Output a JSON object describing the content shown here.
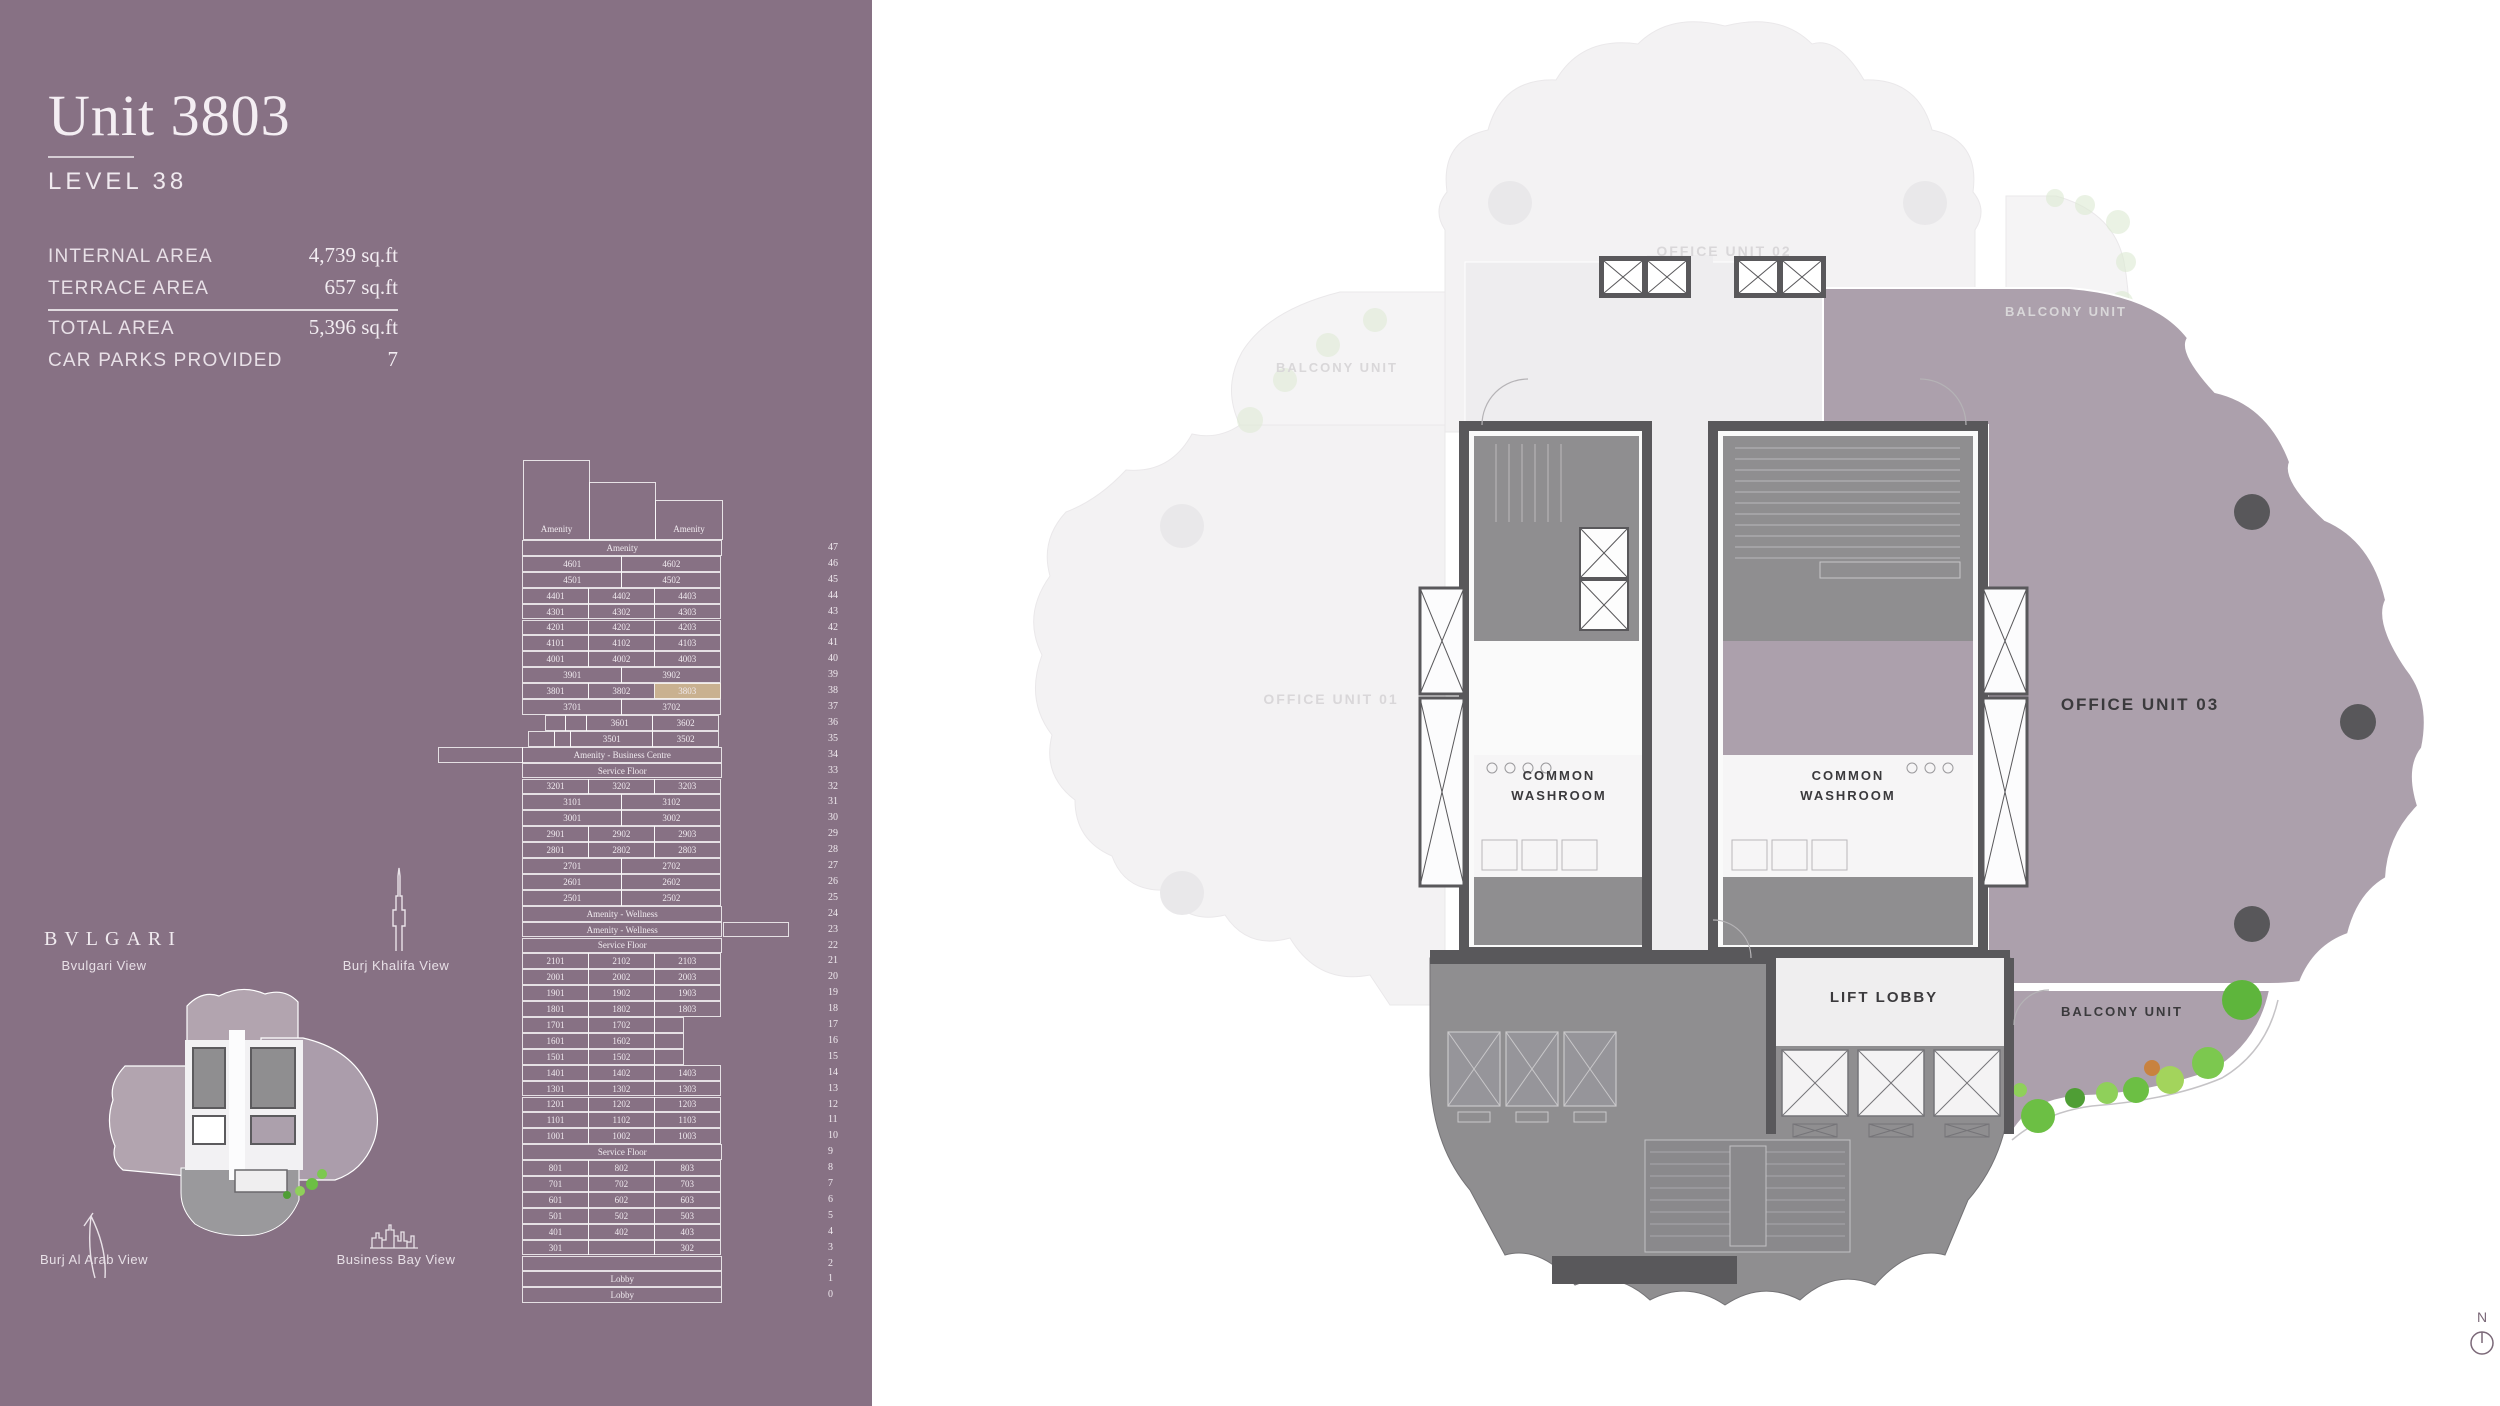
{
  "colors": {
    "panel_bg": "#877184",
    "highlight": "#C9B190",
    "mauve_unit": "#ACA0AC",
    "wall_dark": "#59585b",
    "service_gray": "#8f8e90",
    "faint_fill": "#f3f2f3",
    "corridor_light": "#eeedef",
    "green": "#6cbf44",
    "text_light": "#F0EAEF",
    "text_dark": "#3b3a3d"
  },
  "panel": {
    "title": "Unit 3803",
    "subtitle": "LEVEL 38",
    "stats": [
      {
        "label": "INTERNAL AREA",
        "value": "4,739 sq.ft"
      },
      {
        "label": "TERRACE AREA",
        "value": "657 sq.ft"
      },
      {
        "label": "TOTAL AREA",
        "value": "5,396 sq.ft"
      },
      {
        "label": "CAR PARKS PROVIDED",
        "value": "7"
      }
    ],
    "brand": "BVLGARI",
    "views": {
      "bvlgari": "Bvulgari View",
      "burj_khalifa": "Burj Khalifa View",
      "burj_al_arab": "Burj Al Arab View",
      "business_bay": "Business Bay View"
    }
  },
  "stacking_plan": {
    "highlight_unit": "3803",
    "top_boxes": [
      {
        "label": "Amenity"
      },
      {
        "label": ""
      },
      {
        "label": "Amenity"
      }
    ],
    "levels": [
      {
        "level": 47,
        "cells": [
          {
            "t": "Amenity",
            "s": 3
          }
        ]
      },
      {
        "level": 46,
        "cells": [
          {
            "t": "4601",
            "s": 1.5
          },
          {
            "t": "4602",
            "s": 1.5
          }
        ]
      },
      {
        "level": 45,
        "cells": [
          {
            "t": "4501",
            "s": 1.5
          },
          {
            "t": "4502",
            "s": 1.5
          }
        ]
      },
      {
        "level": 44,
        "cells": [
          {
            "t": "4401",
            "s": 1
          },
          {
            "t": "4402",
            "s": 1
          },
          {
            "t": "4403",
            "s": 1
          }
        ]
      },
      {
        "level": 43,
        "cells": [
          {
            "t": "4301",
            "s": 1
          },
          {
            "t": "4302",
            "s": 1
          },
          {
            "t": "4303",
            "s": 1
          }
        ]
      },
      {
        "level": 42,
        "cells": [
          {
            "t": "4201",
            "s": 1
          },
          {
            "t": "4202",
            "s": 1
          },
          {
            "t": "4203",
            "s": 1
          }
        ]
      },
      {
        "level": 41,
        "cells": [
          {
            "t": "4101",
            "s": 1
          },
          {
            "t": "4102",
            "s": 1
          },
          {
            "t": "4103",
            "s": 1
          }
        ]
      },
      {
        "level": 40,
        "cells": [
          {
            "t": "4001",
            "s": 1
          },
          {
            "t": "4002",
            "s": 1
          },
          {
            "t": "4003",
            "s": 1
          }
        ]
      },
      {
        "level": 39,
        "cells": [
          {
            "t": "3901",
            "s": 1.5
          },
          {
            "t": "3902",
            "s": 1.5
          }
        ]
      },
      {
        "level": 38,
        "cells": [
          {
            "t": "3801",
            "s": 1
          },
          {
            "t": "3802",
            "s": 1
          },
          {
            "t": "3803",
            "s": 1,
            "h": true
          }
        ]
      },
      {
        "level": 37,
        "cells": [
          {
            "t": "3701",
            "s": 1.5
          },
          {
            "t": "3702",
            "s": 1.5
          }
        ]
      },
      {
        "level": 36,
        "cells": [
          {
            "t": "",
            "s": 0.35,
            "g": true
          },
          {
            "t": "",
            "s": 0.32
          },
          {
            "t": "",
            "s": 0.33
          },
          {
            "t": "3601",
            "s": 1
          },
          {
            "t": "3602",
            "s": 1
          }
        ]
      },
      {
        "level": 35,
        "cells": [
          {
            "t": "",
            "s": 0.1,
            "g": true
          },
          {
            "t": "",
            "s": 0.4
          },
          {
            "t": "",
            "s": 0.26
          },
          {
            "t": "3501",
            "s": 1.24
          },
          {
            "t": "3502",
            "s": 1
          }
        ]
      },
      {
        "level": 34,
        "cells": [
          {
            "t": "Amenity - Business Centre",
            "s": 3
          }
        ],
        "ext_left": true
      },
      {
        "level": 33,
        "cells": [
          {
            "t": "Service Floor",
            "s": 3
          }
        ]
      },
      {
        "level": 32,
        "cells": [
          {
            "t": "3201",
            "s": 1
          },
          {
            "t": "3202",
            "s": 1
          },
          {
            "t": "3203",
            "s": 1
          }
        ]
      },
      {
        "level": 31,
        "cells": [
          {
            "t": "3101",
            "s": 1.5
          },
          {
            "t": "3102",
            "s": 1.5
          }
        ]
      },
      {
        "level": 30,
        "cells": [
          {
            "t": "3001",
            "s": 1.5
          },
          {
            "t": "3002",
            "s": 1.5
          }
        ]
      },
      {
        "level": 29,
        "cells": [
          {
            "t": "2901",
            "s": 1
          },
          {
            "t": "2902",
            "s": 1
          },
          {
            "t": "2903",
            "s": 1
          }
        ]
      },
      {
        "level": 28,
        "cells": [
          {
            "t": "2801",
            "s": 1
          },
          {
            "t": "2802",
            "s": 1
          },
          {
            "t": "2803",
            "s": 1
          }
        ]
      },
      {
        "level": 27,
        "cells": [
          {
            "t": "2701",
            "s": 1.5
          },
          {
            "t": "2702",
            "s": 1.5
          }
        ]
      },
      {
        "level": 26,
        "cells": [
          {
            "t": "2601",
            "s": 1.5
          },
          {
            "t": "2602",
            "s": 1.5
          }
        ]
      },
      {
        "level": 25,
        "cells": [
          {
            "t": "2501",
            "s": 1.5
          },
          {
            "t": "2502",
            "s": 1.5
          }
        ]
      },
      {
        "level": 24,
        "cells": [
          {
            "t": "Amenity - Wellness",
            "s": 3
          }
        ]
      },
      {
        "level": 23,
        "cells": [
          {
            "t": "Amenity - Wellness",
            "s": 3
          }
        ],
        "ext_right": true
      },
      {
        "level": 22,
        "cells": [
          {
            "t": "Service Floor",
            "s": 3
          }
        ]
      },
      {
        "level": 21,
        "cells": [
          {
            "t": "2101",
            "s": 1
          },
          {
            "t": "2102",
            "s": 1
          },
          {
            "t": "2103",
            "s": 1
          }
        ]
      },
      {
        "level": 20,
        "cells": [
          {
            "t": "2001",
            "s": 1
          },
          {
            "t": "2002",
            "s": 1
          },
          {
            "t": "2003",
            "s": 1
          }
        ]
      },
      {
        "level": 19,
        "cells": [
          {
            "t": "1901",
            "s": 1
          },
          {
            "t": "1902",
            "s": 1
          },
          {
            "t": "1903",
            "s": 1
          }
        ]
      },
      {
        "level": 18,
        "cells": [
          {
            "t": "1801",
            "s": 1
          },
          {
            "t": "1802",
            "s": 1
          },
          {
            "t": "1803",
            "s": 1
          }
        ]
      },
      {
        "level": 17,
        "cells": [
          {
            "t": "1701",
            "s": 1
          },
          {
            "t": "1702",
            "s": 1
          },
          {
            "t": "",
            "s": 0.45
          },
          {
            "t": "",
            "s": 0.55,
            "g": true
          }
        ]
      },
      {
        "level": 16,
        "cells": [
          {
            "t": "1601",
            "s": 1
          },
          {
            "t": "1602",
            "s": 1
          },
          {
            "t": "",
            "s": 0.45
          },
          {
            "t": "",
            "s": 0.55,
            "g": true
          }
        ]
      },
      {
        "level": 15,
        "cells": [
          {
            "t": "1501",
            "s": 1
          },
          {
            "t": "1502",
            "s": 1
          },
          {
            "t": "",
            "s": 0.45
          },
          {
            "t": "",
            "s": 0.55,
            "g": true
          }
        ]
      },
      {
        "level": 14,
        "cells": [
          {
            "t": "1401",
            "s": 1
          },
          {
            "t": "1402",
            "s": 1
          },
          {
            "t": "1403",
            "s": 1
          }
        ]
      },
      {
        "level": 13,
        "cells": [
          {
            "t": "1301",
            "s": 1
          },
          {
            "t": "1302",
            "s": 1
          },
          {
            "t": "1303",
            "s": 1
          }
        ]
      },
      {
        "level": 12,
        "cells": [
          {
            "t": "1201",
            "s": 1
          },
          {
            "t": "1202",
            "s": 1
          },
          {
            "t": "1203",
            "s": 1
          }
        ]
      },
      {
        "level": 11,
        "cells": [
          {
            "t": "1101",
            "s": 1
          },
          {
            "t": "1102",
            "s": 1
          },
          {
            "t": "1103",
            "s": 1
          }
        ]
      },
      {
        "level": 10,
        "cells": [
          {
            "t": "1001",
            "s": 1
          },
          {
            "t": "1002",
            "s": 1
          },
          {
            "t": "1003",
            "s": 1
          }
        ]
      },
      {
        "level": 9,
        "cells": [
          {
            "t": "Service Floor",
            "s": 3
          }
        ]
      },
      {
        "level": 8,
        "cells": [
          {
            "t": "801",
            "s": 1
          },
          {
            "t": "802",
            "s": 1
          },
          {
            "t": "803",
            "s": 1
          }
        ]
      },
      {
        "level": 7,
        "cells": [
          {
            "t": "701",
            "s": 1
          },
          {
            "t": "702",
            "s": 1
          },
          {
            "t": "703",
            "s": 1
          }
        ]
      },
      {
        "level": 6,
        "cells": [
          {
            "t": "601",
            "s": 1
          },
          {
            "t": "602",
            "s": 1
          },
          {
            "t": "603",
            "s": 1
          }
        ]
      },
      {
        "level": 5,
        "cells": [
          {
            "t": "501",
            "s": 1
          },
          {
            "t": "502",
            "s": 1
          },
          {
            "t": "503",
            "s": 1
          }
        ]
      },
      {
        "level": 4,
        "cells": [
          {
            "t": "401",
            "s": 1
          },
          {
            "t": "402",
            "s": 1
          },
          {
            "t": "403",
            "s": 1
          }
        ]
      },
      {
        "level": 3,
        "cells": [
          {
            "t": "301",
            "s": 1
          },
          {
            "t": "",
            "s": 1
          },
          {
            "t": "302",
            "s": 1
          }
        ]
      },
      {
        "level": 2,
        "cells": [
          {
            "t": "",
            "s": 3
          }
        ]
      },
      {
        "level": 1,
        "cells": [
          {
            "t": "Lobby",
            "s": 3
          }
        ]
      },
      {
        "level": 0,
        "cells": [
          {
            "t": "Lobby",
            "s": 3
          }
        ]
      }
    ]
  },
  "floor_plan": {
    "labels": {
      "office_unit_01": "OFFICE UNIT 01",
      "office_unit_02": "OFFICE UNIT 02",
      "office_unit_03": "OFFICE UNIT 03",
      "balcony_unit": "BALCONY UNIT",
      "washroom_top": "COMMON",
      "washroom_bottom": "WASHROOM",
      "lift_lobby": "LIFT LOBBY",
      "compass_n": "N"
    }
  }
}
